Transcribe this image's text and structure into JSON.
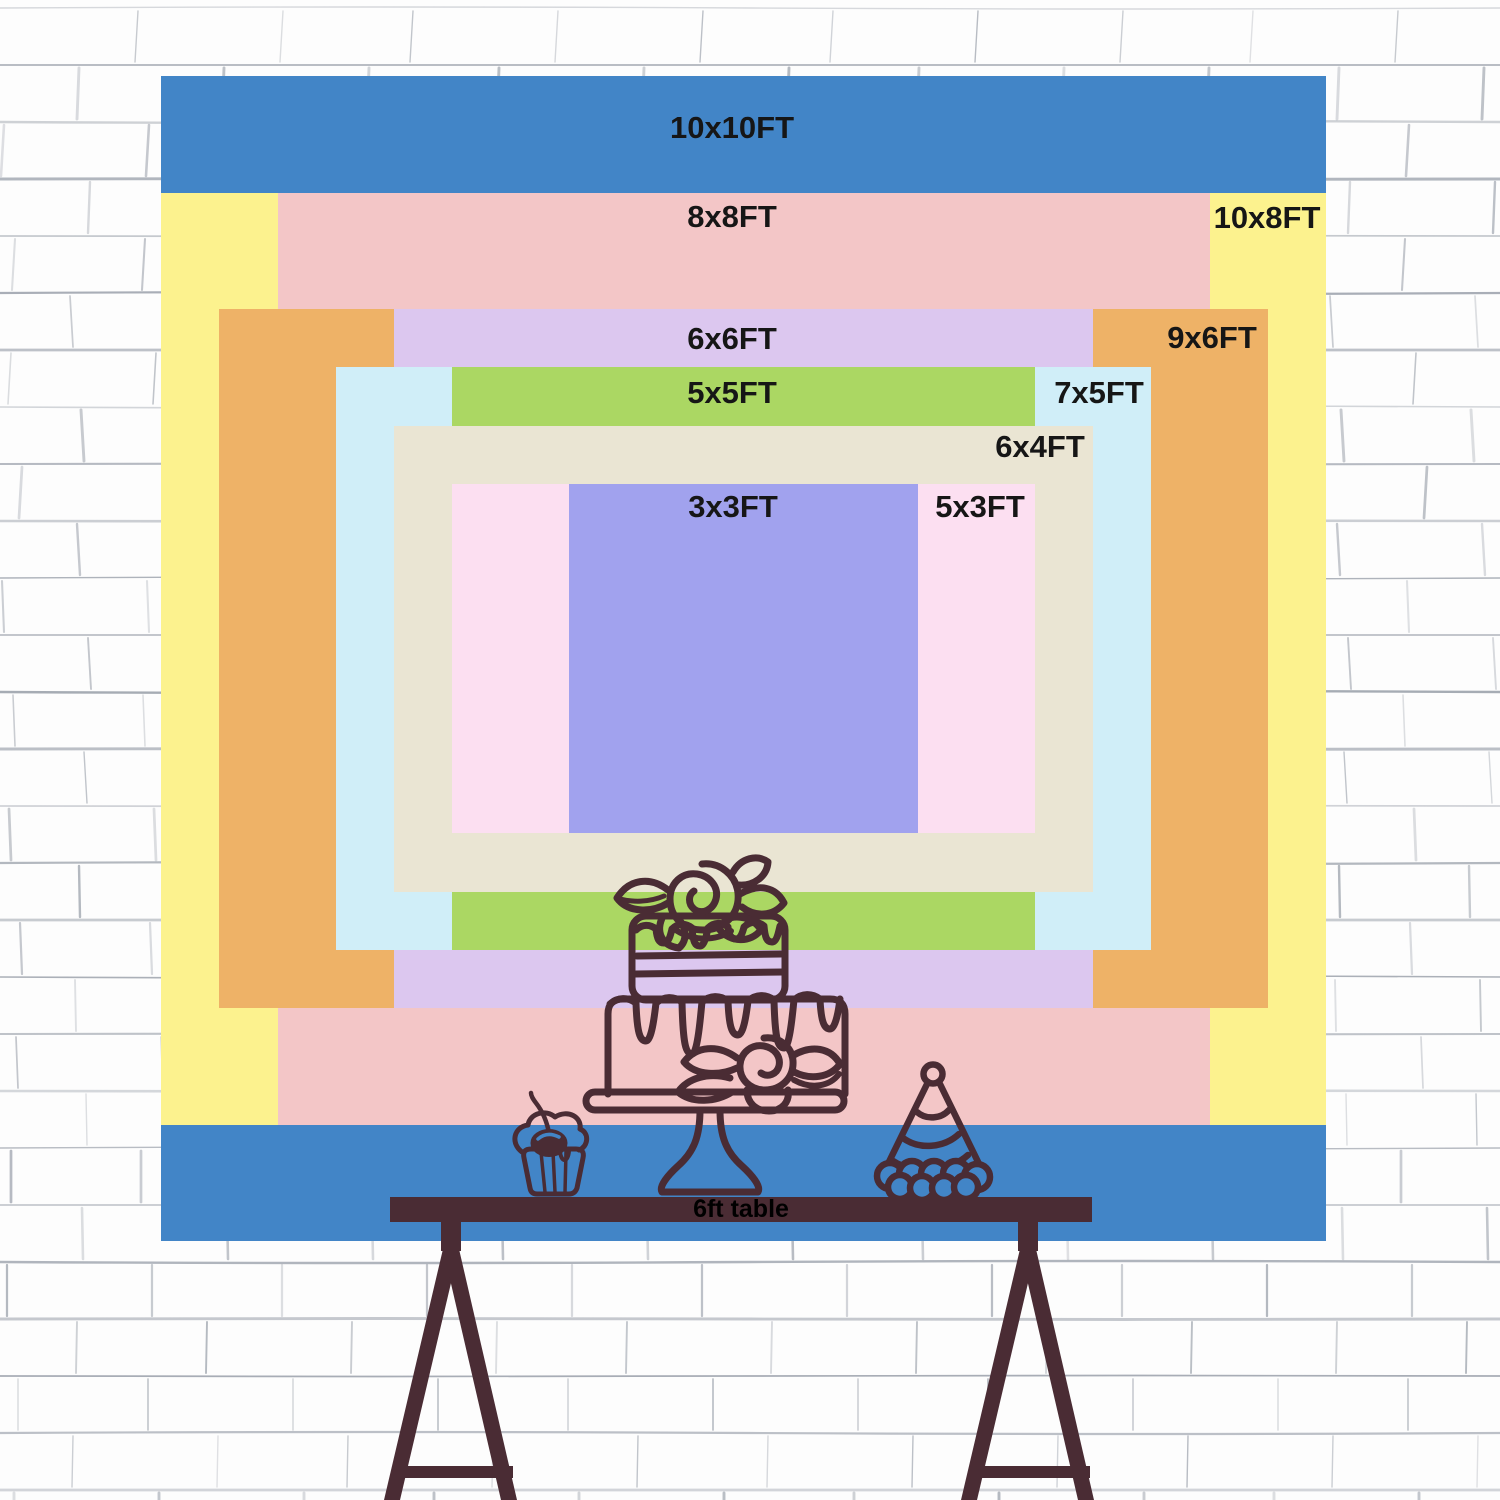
{
  "backdrop": {
    "description": "nested backdrop size chart",
    "label_color": "#161616",
    "layers": [
      {
        "id": "10x10",
        "label": "10x10FT",
        "color": "#4285c7",
        "w_ft": 10,
        "h_ft": 10
      },
      {
        "id": "10x8",
        "label": "10x8FT",
        "color": "#fcf28e",
        "w_ft": 10,
        "h_ft": 8
      },
      {
        "id": "8x8",
        "label": "8x8FT",
        "color": "#f3c6c7",
        "w_ft": 8,
        "h_ft": 8
      },
      {
        "id": "9x6",
        "label": "9x6FT",
        "color": "#eeb267",
        "w_ft": 9,
        "h_ft": 6
      },
      {
        "id": "6x6",
        "label": "6x6FT",
        "color": "#dcc7ef",
        "w_ft": 6,
        "h_ft": 6
      },
      {
        "id": "7x5",
        "label": "7x5FT",
        "color": "#d0eef8",
        "w_ft": 7,
        "h_ft": 5
      },
      {
        "id": "5x5",
        "label": "5x5FT",
        "color": "#abd763",
        "w_ft": 5,
        "h_ft": 5
      },
      {
        "id": "6x4",
        "label": "6x4FT",
        "color": "#eae5d3",
        "w_ft": 6,
        "h_ft": 4
      },
      {
        "id": "5x3",
        "label": "5x3FT",
        "color": "#fcdff1",
        "w_ft": 5,
        "h_ft": 3
      },
      {
        "id": "3x3",
        "label": "3x3FT",
        "color": "#a1a2ee",
        "w_ft": 3,
        "h_ft": 3
      }
    ]
  },
  "table": {
    "label": "6ft table",
    "color": "#4a2c34",
    "text_color": "#000000"
  },
  "doodles": {
    "stroke_color": "#4a2c34",
    "items": [
      "birthday-cake",
      "cupcake",
      "party-hat"
    ]
  },
  "wall": {
    "background": "#fdfdfd",
    "line_color": "#9aa0aa"
  }
}
